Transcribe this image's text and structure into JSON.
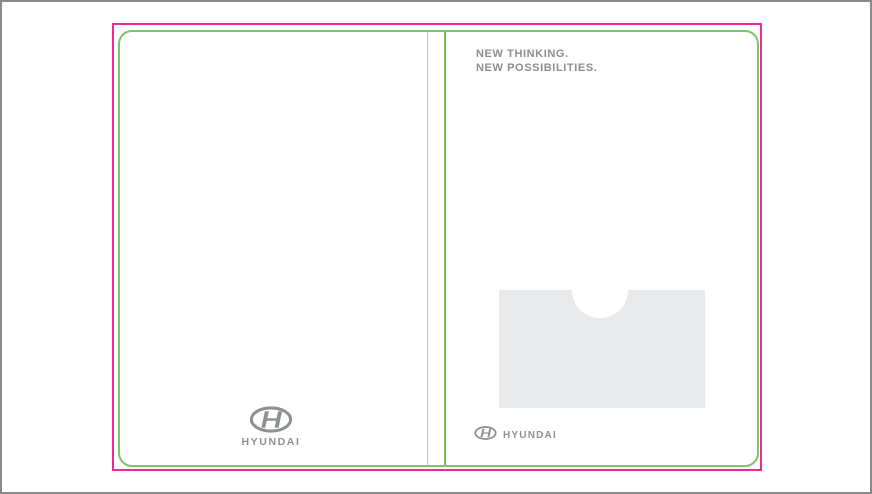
{
  "artboard": {
    "description": "Hyundai presentation folder die-cut artwork preview",
    "colors": {
      "frame_gray": "#8a8a8a",
      "trim_magenta": "#ec2b90",
      "die_line_green": "#7cc465",
      "fold_line_light_green": "#a9d4a0",
      "spine_line_green": "#6fbf58",
      "text_gray": "#8b8d90",
      "logo_gray": "#8d9093",
      "pocket_gray": "#e9eaeb"
    }
  },
  "right_panel": {
    "headline": {
      "line1": "NEW THINKING.",
      "line2": "NEW POSSIBILITIES."
    },
    "logo": {
      "icon": "hyundai-logo-icon",
      "wordmark": "HYUNDAI"
    },
    "pocket": "die-cut pocket with thumb notch"
  },
  "left_panel": {
    "logo": {
      "icon": "hyundai-logo-icon",
      "wordmark": "HYUNDAI"
    }
  }
}
